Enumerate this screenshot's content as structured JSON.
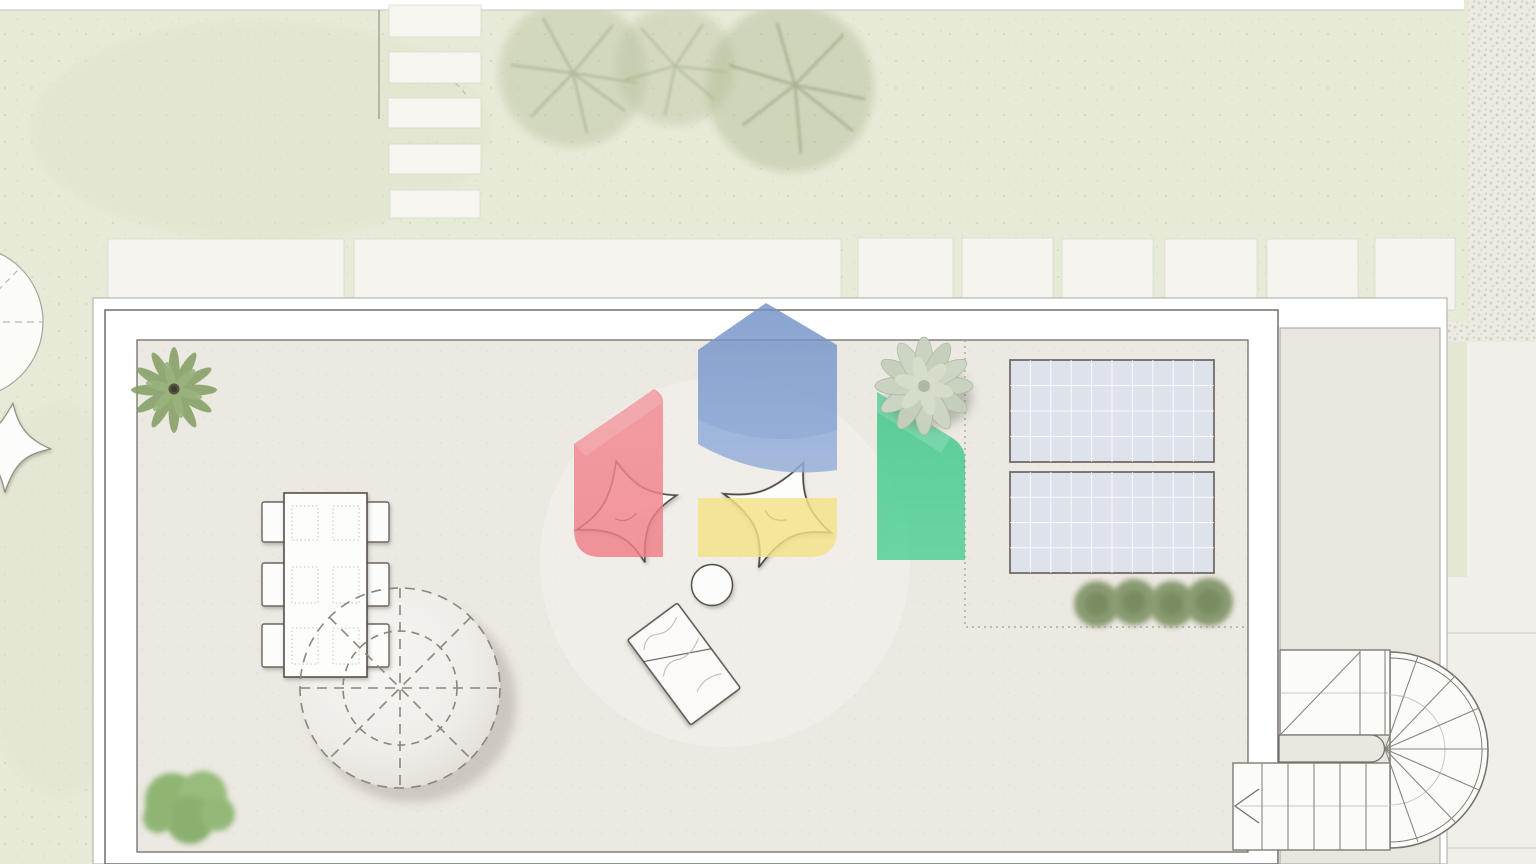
{
  "scene": {
    "title": "Roof terrace architectural floor plan (top view) with Google Home logo watermark",
    "visible_text": "none",
    "watermark": "google-home-logo"
  },
  "palette": {
    "lawn": "#E7EAD7",
    "lawn_speckle": "#C9D0B0",
    "terrace_floor": "#ECE8E2",
    "side_terrace_floor": "#E9E6DF",
    "wall_white": "#FFFFFF",
    "outline_dark": "#6F6B66",
    "outline_light": "#B9B6AE",
    "paving": "#F0EFEA",
    "slab": "#F6F5F0",
    "gravel": "#E6E3DA",
    "solar_panel_fill": "#DEE2EB",
    "solar_panel_frame": "#6F6B66",
    "hedge_green": "#8A9B72",
    "plant_green": "#85A065",
    "bush_green": "#8FB573",
    "succulent_sage": "#C9D3C0",
    "logo_blue": "#7B9CD0",
    "logo_red": "#F1838B",
    "logo_yellow": "#F4E286",
    "logo_green": "#42CA8C",
    "furniture_outline": "#4F4A45",
    "dash_gray": "#8B867D"
  },
  "garden": {
    "stepping_stones_column_count": 5,
    "paving_slab_row_count": 8,
    "faint_trees_count": 3,
    "edge_line": "garden boundary line with gate swing arc",
    "left_structures": "partial round deck and white bean bag at left edge"
  },
  "terrace": {
    "corner_plant": "spiky green plant, top-left corner",
    "ground_bush": "green bush, bottom-left corner",
    "dining_table": {
      "chairs": 6,
      "shape": "rectangular, 3 chairs per long side"
    },
    "canopy_circle": {
      "style": "dashed outline, 4 spokes, inner dashed ring",
      "fill": "light disc with shadow"
    },
    "lounge": {
      "bean_bags": 2,
      "side_table": 1,
      "marble_lounger": 1
    },
    "tech_zone": {
      "outline": "dotted",
      "solar_panels": 2,
      "panel_grid_cols": 10,
      "panel_grid_rows": 4,
      "hedge_shrubs": 4,
      "succulent_plant": 1
    }
  },
  "staircase": {
    "type": "U-shaped stair with half-turn winders",
    "upper_flight_treads": 3,
    "winder_treads": 8,
    "lower_flight_treads": 6,
    "direction_arrow": "chevron pointing left"
  },
  "logo": {
    "parts": [
      "blue-house-shape",
      "red-pentagon-shape",
      "yellow-rectangle-shape",
      "green-shield-shape"
    ],
    "opacity": 0.82
  }
}
